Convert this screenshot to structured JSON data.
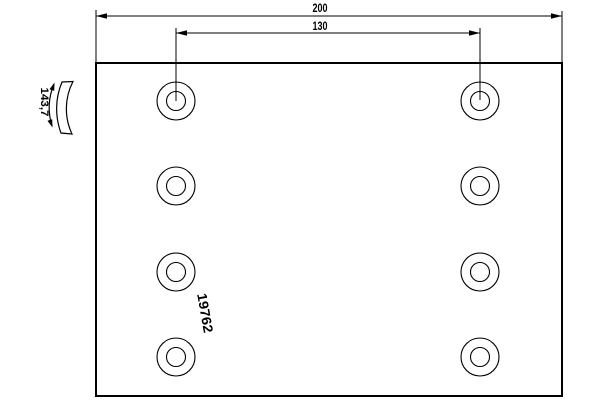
{
  "page": {
    "background": "#ffffff",
    "line_color": "#000000"
  },
  "drawing": {
    "part_number": "19762",
    "dim_overall_length": "200",
    "dim_hole_spacing": "130",
    "dim_arc_width": "143,7",
    "holes": {
      "count": 8,
      "columns_x": [
        176,
        480
      ],
      "rows_y": [
        101,
        186,
        272,
        357
      ],
      "outer_radius": 19,
      "inner_radius": 9.5
    }
  }
}
